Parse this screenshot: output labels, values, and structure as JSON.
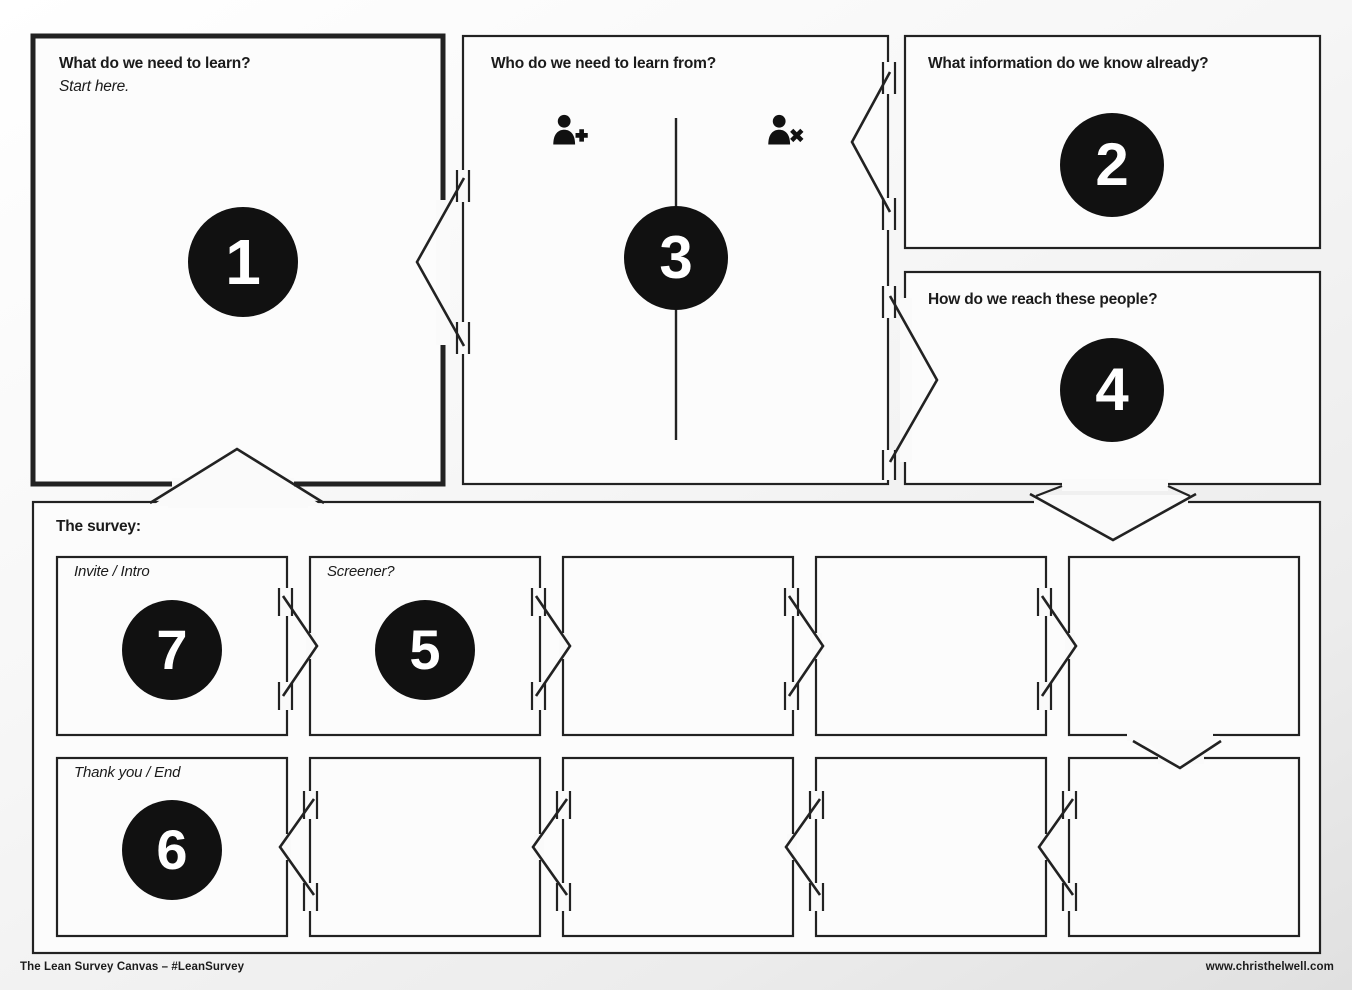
{
  "boxes": {
    "learn": {
      "title": "What do we need to learn?",
      "subtitle": "Start here.",
      "number": "1"
    },
    "who": {
      "title": "Who do we need to learn from?",
      "number": "3"
    },
    "know": {
      "title": "What information do we know already?",
      "number": "2"
    },
    "reach": {
      "title": "How do we reach these people?",
      "number": "4"
    }
  },
  "survey": {
    "title": "The survey:",
    "row1": [
      {
        "label": "Invite / Intro",
        "number": "7"
      },
      {
        "label": "Screener?",
        "number": "5"
      },
      {
        "label": ""
      },
      {
        "label": ""
      },
      {
        "label": ""
      }
    ],
    "row2": [
      {
        "label": "Thank you / End",
        "number": "6"
      },
      {
        "label": ""
      },
      {
        "label": ""
      },
      {
        "label": ""
      },
      {
        "label": ""
      }
    ]
  },
  "icons": {
    "who_box": [
      "person-add-icon",
      "person-remove-icon"
    ]
  },
  "footer": {
    "left": "The Lean Survey Canvas – #LeanSurvey",
    "right": "www.christhelwell.com"
  },
  "colors": {
    "ink": "#222222",
    "circle_fill": "#111111",
    "box_fill": "#fcfcfc"
  }
}
